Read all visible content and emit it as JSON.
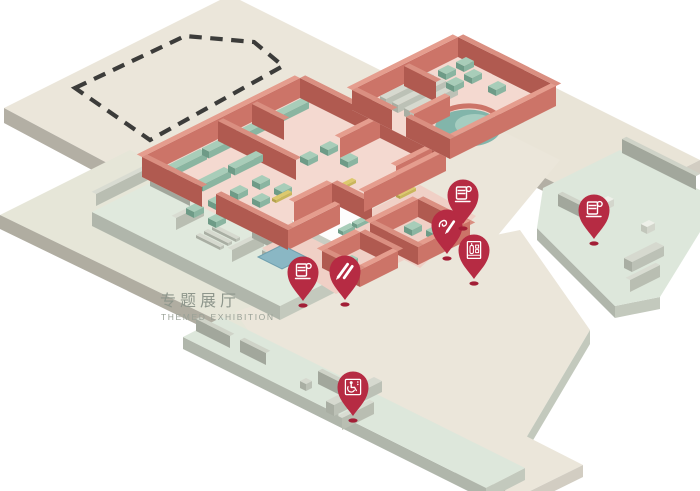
{
  "map": {
    "title_cn": "专题展厅",
    "title_en": "THEMED EXHIBITION",
    "pins": [
      {
        "icon": "water-cup-icon",
        "name": "drinking-water-south",
        "x": 303,
        "y": 272
      },
      {
        "icon": "pens-icon",
        "name": "writing-area",
        "x": 345,
        "y": 271
      },
      {
        "icon": "signature-pen-icon",
        "name": "signature-area",
        "x": 447,
        "y": 225
      },
      {
        "icon": "water-cup-icon",
        "name": "drinking-water-center",
        "x": 463,
        "y": 195
      },
      {
        "icon": "vending-machine-icon",
        "name": "vending-machine",
        "x": 474,
        "y": 250
      },
      {
        "icon": "water-cup-icon",
        "name": "drinking-water-east",
        "x": 594,
        "y": 210
      },
      {
        "icon": "wheelchair-icon",
        "name": "accessible-facility",
        "x": 353,
        "y": 387
      }
    ],
    "colors": {
      "pin": "#b62b43",
      "pin_shadow": "#a21e36",
      "wall_face": "#cc7468",
      "wall_face_dark": "#b05a50",
      "wall_top": "#e59d8e",
      "wall_top_dark": "#da8f81",
      "floor_pink": "#f4d9d0",
      "platform": "#ebe6da",
      "wing_floor": "#e0e9dd",
      "case_top": "#a8cdb9",
      "pool": "#8ab7c4",
      "dashed_outline": "#3c3c3a"
    }
  }
}
